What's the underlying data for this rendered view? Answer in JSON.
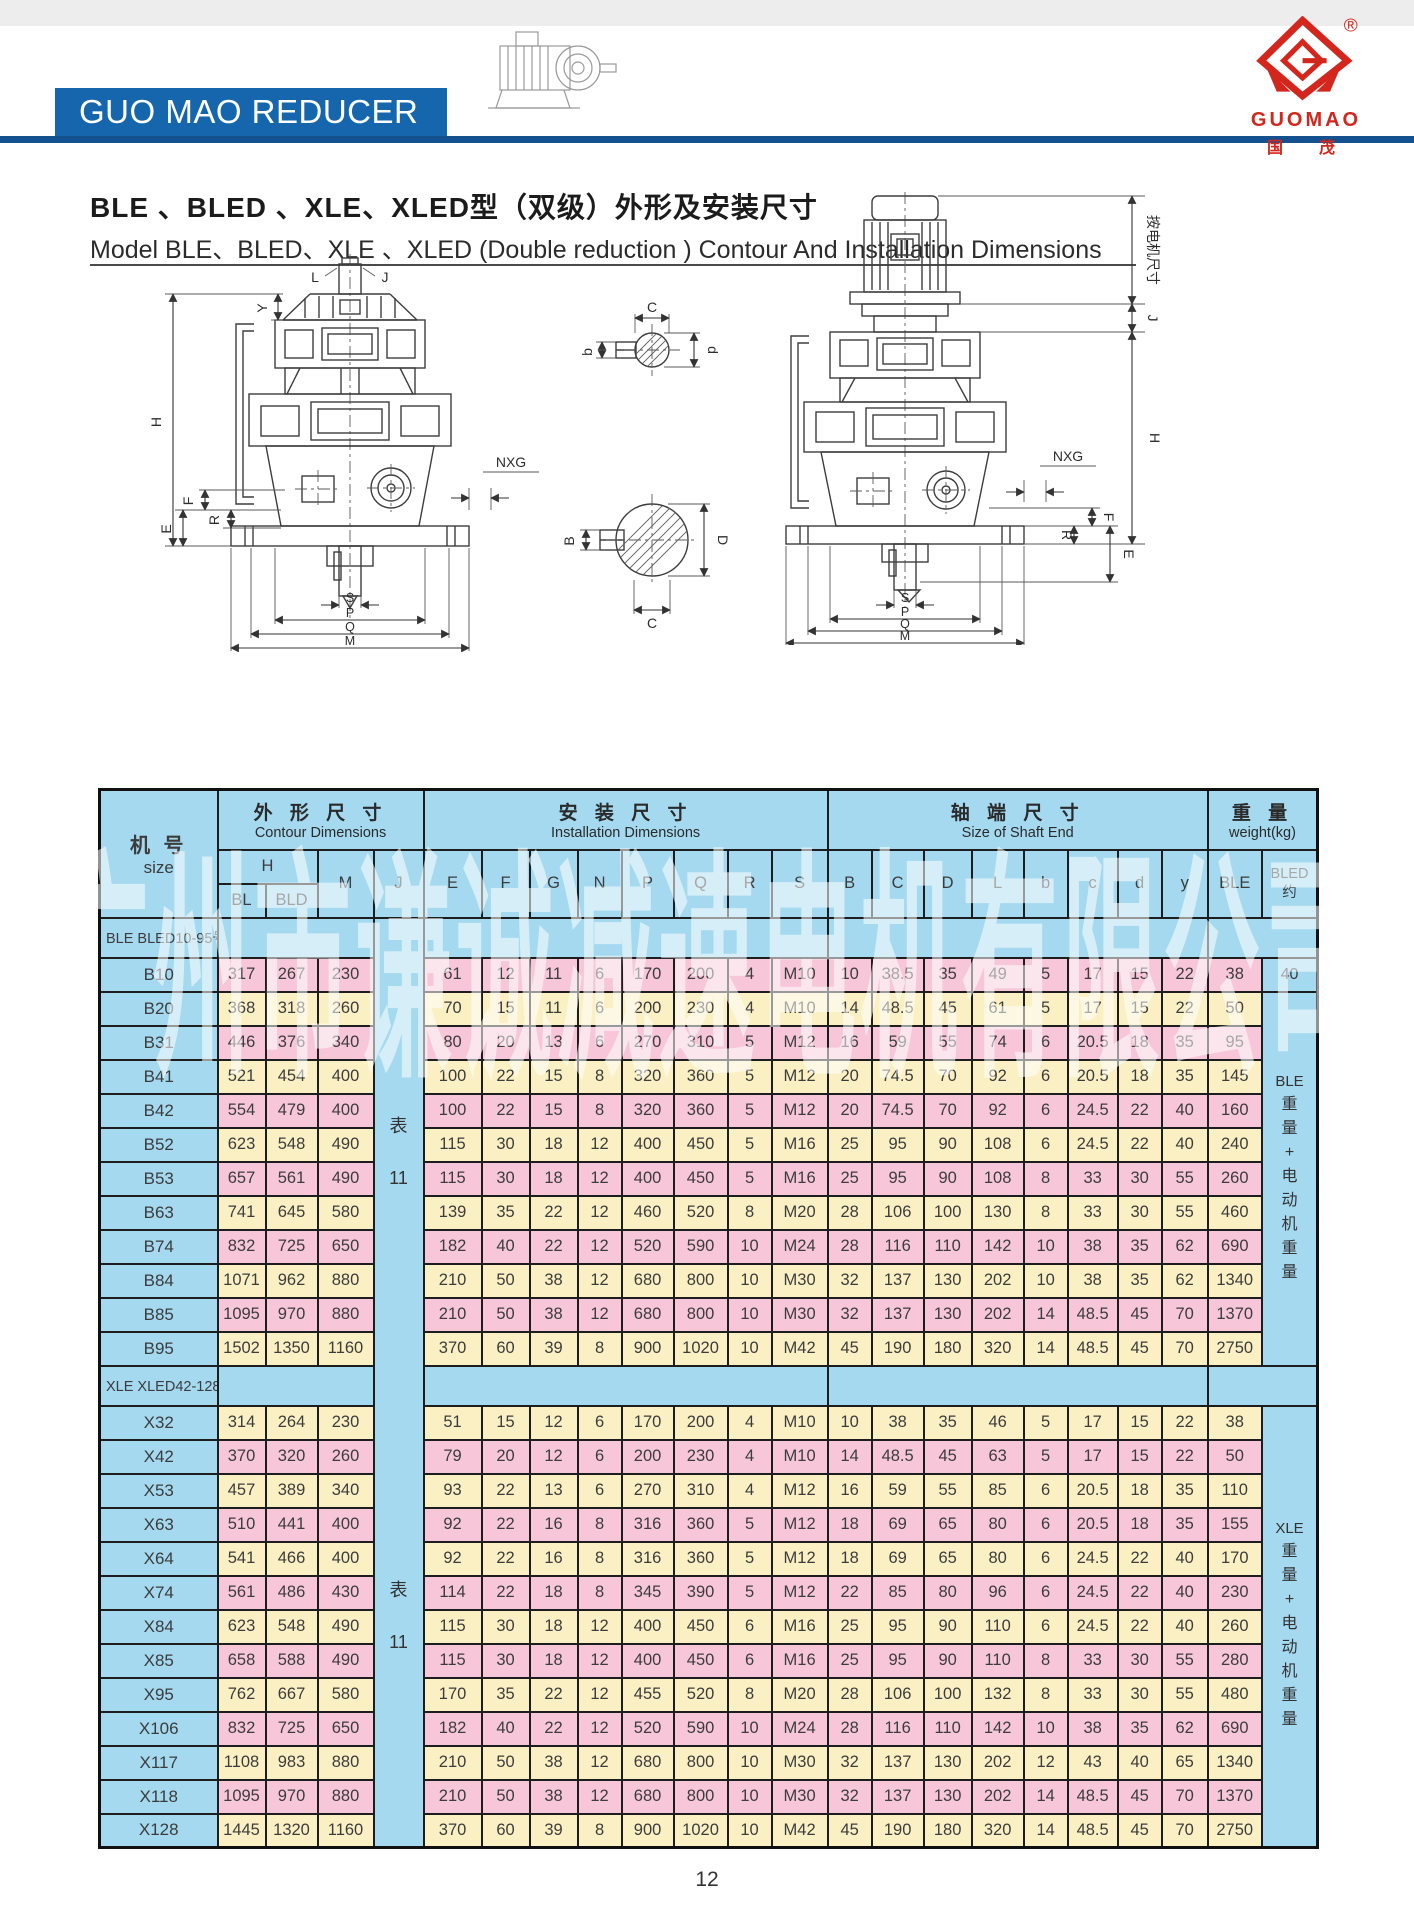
{
  "header": {
    "banner": "GUO MAO REDUCER",
    "logo": {
      "name": "GUOMAO",
      "cn": "国　茂",
      "registered": "®"
    }
  },
  "title": {
    "cn": "BLE 、BLED 、XLE、XLED型（双级）外形及安装尺寸",
    "en": "Model BLE、BLED、XLE 、XLED (Double reduction ) Contour And Installation Dimensions"
  },
  "watermark": "广州市谦诚减速电机有限公司",
  "page_number": "12",
  "drawings": {
    "left": {
      "y": "Y",
      "l": "L",
      "j": "J",
      "h": "H",
      "f": "F",
      "e": "E",
      "r": "R",
      "nxg": "NXG",
      "s": "S",
      "p": "P",
      "q": "Q",
      "m": "M"
    },
    "sections": {
      "small_c": "C",
      "small_b": "b",
      "small_d": "d",
      "large_b": "B",
      "large_d": "D",
      "large_c": "C"
    },
    "right": {
      "motor_note": "按电机尺寸",
      "j": "J",
      "h": "H",
      "nxg": "NXG",
      "f": "F",
      "r": "R",
      "e": "E",
      "s": "S",
      "p": "P",
      "q": "Q",
      "m": "M"
    }
  },
  "table": {
    "headers": {
      "size_cn": "机 号",
      "size_en": "size",
      "contour_cn": "外 形 尺 寸",
      "contour_en": "Contour Dimensions",
      "install_cn": "安 装 尺 寸",
      "install_en": "Installation  Dimensions",
      "shaft_cn": "轴 端 尺 寸",
      "shaft_en": "Size of Shaft  End",
      "weight_cn": "重 量",
      "weight_en": "weight(kg)",
      "h": "H",
      "bl": "BL",
      "bld": "BLD",
      "m": "M",
      "j": "J",
      "install_cols": [
        "E",
        "F",
        "G",
        "N",
        "P",
        "Q",
        "R",
        "S"
      ],
      "shaft_cols": [
        "B",
        "C",
        "D",
        "L",
        "b",
        "c",
        "d",
        "y"
      ],
      "ble": "BLE",
      "bled_line1": "BLED",
      "bled_line2": "约"
    },
    "j_note": {
      "cn": "表",
      "num": "11"
    },
    "sections": [
      {
        "label": "BLE BLED10-95号",
        "weight_head": "BLE",
        "weight_chars": "重量+电动机重量",
        "first_bled_weight": "40",
        "rows": [
          {
            "size": "B10",
            "values": [
              317,
              267,
              230,
              61,
              12,
              11,
              6,
              170,
              200,
              4,
              "M10",
              10,
              38.5,
              35,
              49,
              5,
              17,
              15,
              22,
              38
            ]
          },
          {
            "size": "B20",
            "values": [
              368,
              318,
              260,
              70,
              15,
              11,
              6,
              200,
              230,
              4,
              "M10",
              14,
              48.5,
              45,
              61,
              5,
              17,
              15,
              22,
              50
            ]
          },
          {
            "size": "B31",
            "values": [
              446,
              376,
              340,
              80,
              20,
              13,
              6,
              270,
              310,
              5,
              "M12",
              16,
              59,
              55,
              74,
              6,
              20.5,
              18,
              35,
              95
            ]
          },
          {
            "size": "B41",
            "values": [
              521,
              454,
              400,
              100,
              22,
              15,
              8,
              320,
              360,
              5,
              "M12",
              20,
              74.5,
              70,
              92,
              6,
              20.5,
              18,
              35,
              145
            ]
          },
          {
            "size": "B42",
            "values": [
              554,
              479,
              400,
              100,
              22,
              15,
              8,
              320,
              360,
              5,
              "M12",
              20,
              74.5,
              70,
              92,
              6,
              24.5,
              22,
              40,
              160
            ]
          },
          {
            "size": "B52",
            "values": [
              623,
              548,
              490,
              115,
              30,
              18,
              12,
              400,
              450,
              5,
              "M16",
              25,
              95,
              90,
              108,
              6,
              24.5,
              22,
              40,
              240
            ]
          },
          {
            "size": "B53",
            "values": [
              657,
              561,
              490,
              115,
              30,
              18,
              12,
              400,
              450,
              5,
              "M16",
              25,
              95,
              90,
              108,
              8,
              33,
              30,
              55,
              260
            ]
          },
          {
            "size": "B63",
            "values": [
              741,
              645,
              580,
              139,
              35,
              22,
              12,
              460,
              520,
              8,
              "M20",
              28,
              106,
              100,
              130,
              8,
              33,
              30,
              55,
              460
            ]
          },
          {
            "size": "B74",
            "values": [
              832,
              725,
              650,
              182,
              40,
              22,
              12,
              520,
              590,
              10,
              "M24",
              28,
              116,
              110,
              142,
              10,
              38,
              35,
              62,
              690
            ]
          },
          {
            "size": "B84",
            "values": [
              1071,
              962,
              880,
              210,
              50,
              38,
              12,
              680,
              800,
              10,
              "M30",
              32,
              137,
              130,
              202,
              10,
              38,
              35,
              62,
              1340
            ]
          },
          {
            "size": "B85",
            "values": [
              1095,
              970,
              880,
              210,
              50,
              38,
              12,
              680,
              800,
              10,
              "M30",
              32,
              137,
              130,
              202,
              14,
              48.5,
              45,
              70,
              1370
            ]
          },
          {
            "size": "B95",
            "values": [
              1502,
              1350,
              1160,
              370,
              60,
              39,
              8,
              900,
              1020,
              10,
              "M42",
              45,
              190,
              180,
              320,
              14,
              48.5,
              45,
              70,
              2750
            ]
          }
        ]
      },
      {
        "label": "XLE XLED42-128号",
        "weight_head": "XLE",
        "weight_chars": "重量+电动机重量",
        "rows": [
          {
            "size": "X32",
            "values": [
              314,
              264,
              230,
              51,
              15,
              12,
              6,
              170,
              200,
              4,
              "M10",
              10,
              38,
              35,
              46,
              5,
              17,
              15,
              22,
              38
            ]
          },
          {
            "size": "X42",
            "values": [
              370,
              320,
              260,
              79,
              20,
              12,
              6,
              200,
              230,
              4,
              "M10",
              14,
              48.5,
              45,
              63,
              5,
              17,
              15,
              22,
              50
            ]
          },
          {
            "size": "X53",
            "values": [
              457,
              389,
              340,
              93,
              22,
              13,
              6,
              270,
              310,
              4,
              "M12",
              16,
              59,
              55,
              85,
              6,
              20.5,
              18,
              35,
              110
            ]
          },
          {
            "size": "X63",
            "values": [
              510,
              441,
              400,
              92,
              22,
              16,
              8,
              316,
              360,
              5,
              "M12",
              18,
              69,
              65,
              80,
              6,
              20.5,
              18,
              35,
              155
            ]
          },
          {
            "size": "X64",
            "values": [
              541,
              466,
              400,
              92,
              22,
              16,
              8,
              316,
              360,
              5,
              "M12",
              18,
              69,
              65,
              80,
              6,
              24.5,
              22,
              40,
              170
            ]
          },
          {
            "size": "X74",
            "values": [
              561,
              486,
              430,
              114,
              22,
              18,
              8,
              345,
              390,
              5,
              "M12",
              22,
              85,
              80,
              96,
              6,
              24.5,
              22,
              40,
              230
            ]
          },
          {
            "size": "X84",
            "values": [
              623,
              548,
              490,
              115,
              30,
              18,
              12,
              400,
              450,
              6,
              "M16",
              25,
              95,
              90,
              110,
              6,
              24.5,
              22,
              40,
              260
            ]
          },
          {
            "size": "X85",
            "values": [
              658,
              588,
              490,
              115,
              30,
              18,
              12,
              400,
              450,
              6,
              "M16",
              25,
              95,
              90,
              110,
              8,
              33,
              30,
              55,
              280
            ]
          },
          {
            "size": "X95",
            "values": [
              762,
              667,
              580,
              170,
              35,
              22,
              12,
              455,
              520,
              8,
              "M20",
              28,
              106,
              100,
              132,
              8,
              33,
              30,
              55,
              480
            ]
          },
          {
            "size": "X106",
            "values": [
              832,
              725,
              650,
              182,
              40,
              22,
              12,
              520,
              590,
              10,
              "M24",
              28,
              116,
              110,
              142,
              10,
              38,
              35,
              62,
              690
            ]
          },
          {
            "size": "X117",
            "values": [
              1108,
              983,
              880,
              210,
              50,
              38,
              12,
              680,
              800,
              10,
              "M30",
              32,
              137,
              130,
              202,
              12,
              43,
              40,
              65,
              1340
            ]
          },
          {
            "size": "X118",
            "values": [
              1095,
              970,
              880,
              210,
              50,
              38,
              12,
              680,
              800,
              10,
              "M30",
              32,
              137,
              130,
              202,
              14,
              48.5,
              45,
              70,
              1370
            ]
          },
          {
            "size": "X128",
            "values": [
              1445,
              1320,
              1160,
              370,
              60,
              39,
              8,
              900,
              1020,
              10,
              "M42",
              45,
              190,
              180,
              320,
              14,
              48.5,
              45,
              70,
              2750
            ]
          }
        ]
      }
    ]
  }
}
